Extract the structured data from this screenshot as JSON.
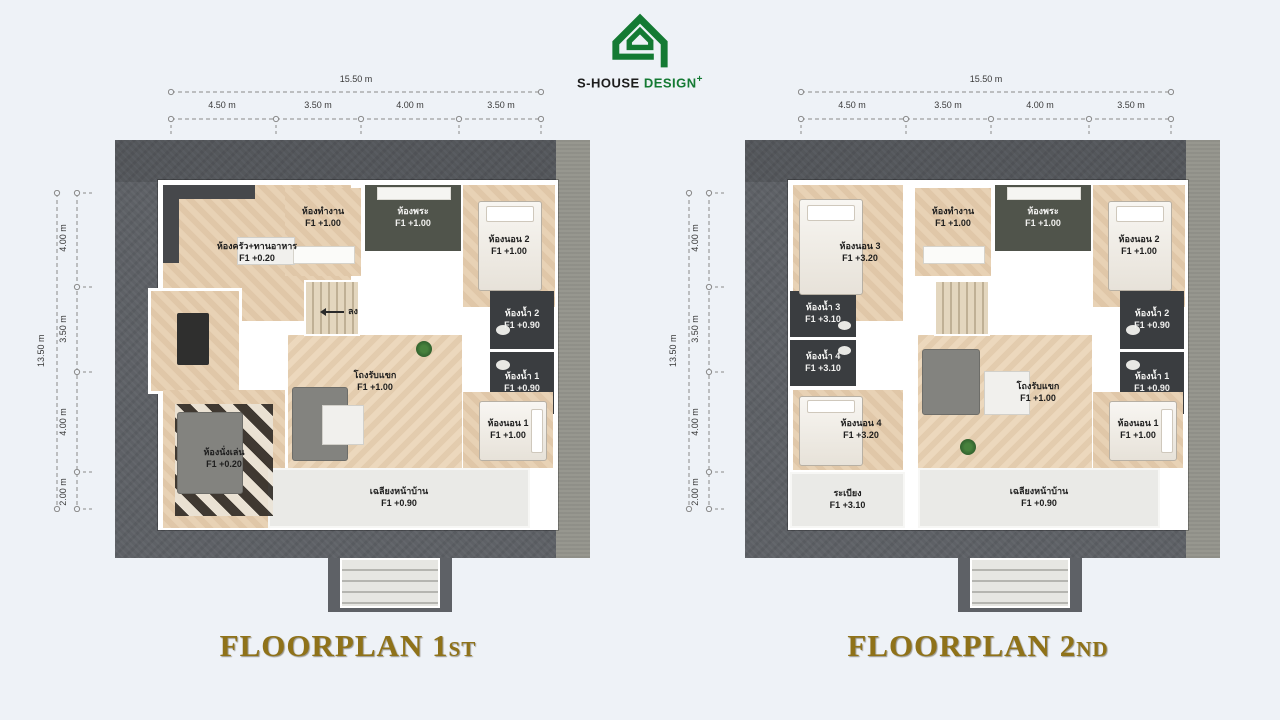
{
  "logo": {
    "brand_black": "S-HOUSE",
    "brand_green": "DESIGN",
    "plus": "+"
  },
  "plans": [
    {
      "title": "FLOORPLAN 1",
      "title_suffix": "ST",
      "dims": {
        "total_width": "15.50 m",
        "width_segments": [
          "4.50 m",
          "3.50 m",
          "4.00 m",
          "3.50 m"
        ],
        "total_height": "13.50 m",
        "height_segments": [
          "4.00 m",
          "3.50 m",
          "4.00 m",
          "2.00 m"
        ]
      },
      "stairs": {
        "label": "ลง"
      },
      "rooms": [
        {
          "name": "ห้องครัว+ทานอาหาร",
          "level": "F1 +0.20"
        },
        {
          "name": "ห้องทำงาน",
          "level": "F1 +1.00"
        },
        {
          "name": "ห้องพระ",
          "level": "F1 +1.00"
        },
        {
          "name": "ห้องนอน 2",
          "level": "F1 +1.00"
        },
        {
          "name": "ห้องน้ำ 2",
          "level": "F1 +0.90"
        },
        {
          "name": "ห้องน้ำ 1",
          "level": "F1 +0.90"
        },
        {
          "name": "โถงรับแขก",
          "level": "F1 +1.00"
        },
        {
          "name": "ห้องนั่งเล่น",
          "level": "F1 +0.20"
        },
        {
          "name": "ห้องนอน 1",
          "level": "F1 +1.00"
        },
        {
          "name": "เฉลียงหน้าบ้าน",
          "level": "F1 +0.90"
        }
      ]
    },
    {
      "title": "FLOORPLAN 2",
      "title_suffix": "ND",
      "dims": {
        "total_width": "15.50 m",
        "width_segments": [
          "4.50 m",
          "3.50 m",
          "4.00 m",
          "3.50 m"
        ],
        "total_height": "13.50 m",
        "height_segments": [
          "4.00 m",
          "3.50 m",
          "4.00 m",
          "2.00 m"
        ]
      },
      "rooms": [
        {
          "name": "ห้องนอน 3",
          "level": "F1 +3.20"
        },
        {
          "name": "ห้องทำงาน",
          "level": "F1 +1.00"
        },
        {
          "name": "ห้องพระ",
          "level": "F1 +1.00"
        },
        {
          "name": "ห้องนอน 2",
          "level": "F1 +1.00"
        },
        {
          "name": "ห้องน้ำ 3",
          "level": "F1 +3.10"
        },
        {
          "name": "ห้องน้ำ 4",
          "level": "F1 +3.10"
        },
        {
          "name": "ห้องน้ำ 2",
          "level": "F1 +0.90"
        },
        {
          "name": "ห้องน้ำ 1",
          "level": "F1 +0.90"
        },
        {
          "name": "ห้องนอน 4",
          "level": "F1 +3.20"
        },
        {
          "name": "ระเบียง",
          "level": "F1 +3.10"
        },
        {
          "name": "โถงรับแขก",
          "level": "F1 +1.00"
        },
        {
          "name": "ห้องนอน 1",
          "level": "F1 +1.00"
        },
        {
          "name": "เฉลียงหน้าบ้าน",
          "level": "F1 +0.90"
        }
      ]
    }
  ],
  "colors": {
    "logo_green": "#147a33",
    "title_gold": "#8f7219",
    "ground": "#5e6166",
    "wood": "#e6cfb1",
    "dark_floor": "#3a3d40"
  }
}
